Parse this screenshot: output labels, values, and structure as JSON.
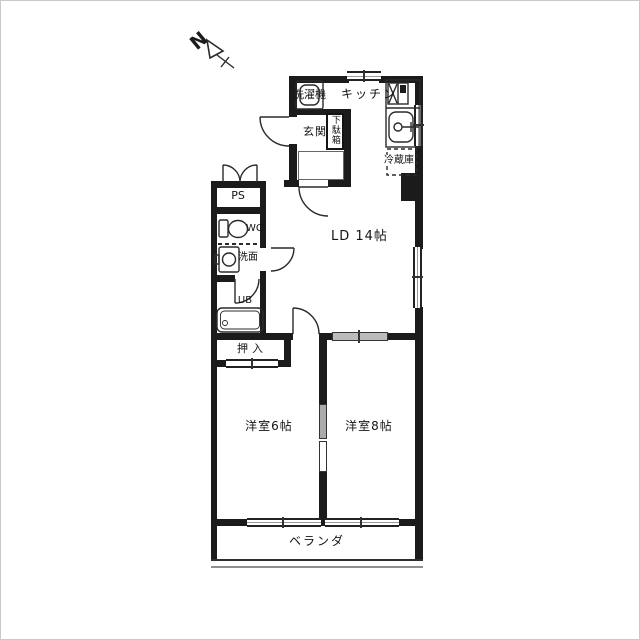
{
  "compass": {
    "label": "N"
  },
  "rooms": {
    "washer": "洗濯機",
    "kitchen": "キッチン",
    "entrance": "玄関",
    "shoe_cabinet": "下駄箱",
    "refrigerator": "冷蔵庫",
    "pipe_space": "PS",
    "toilet": "WC",
    "washroom": "洗面",
    "unit_bath": "UB",
    "closet": "押入",
    "living_dining": "LD 14帖",
    "western_room_6": "洋室6帖",
    "western_room_8": "洋室8帖",
    "balcony": "ベランダ"
  },
  "colors": {
    "wall": "#1b1b1b",
    "line": "#2a2a2a",
    "window_gray": "#bcbcbc",
    "background": "#ffffff"
  }
}
